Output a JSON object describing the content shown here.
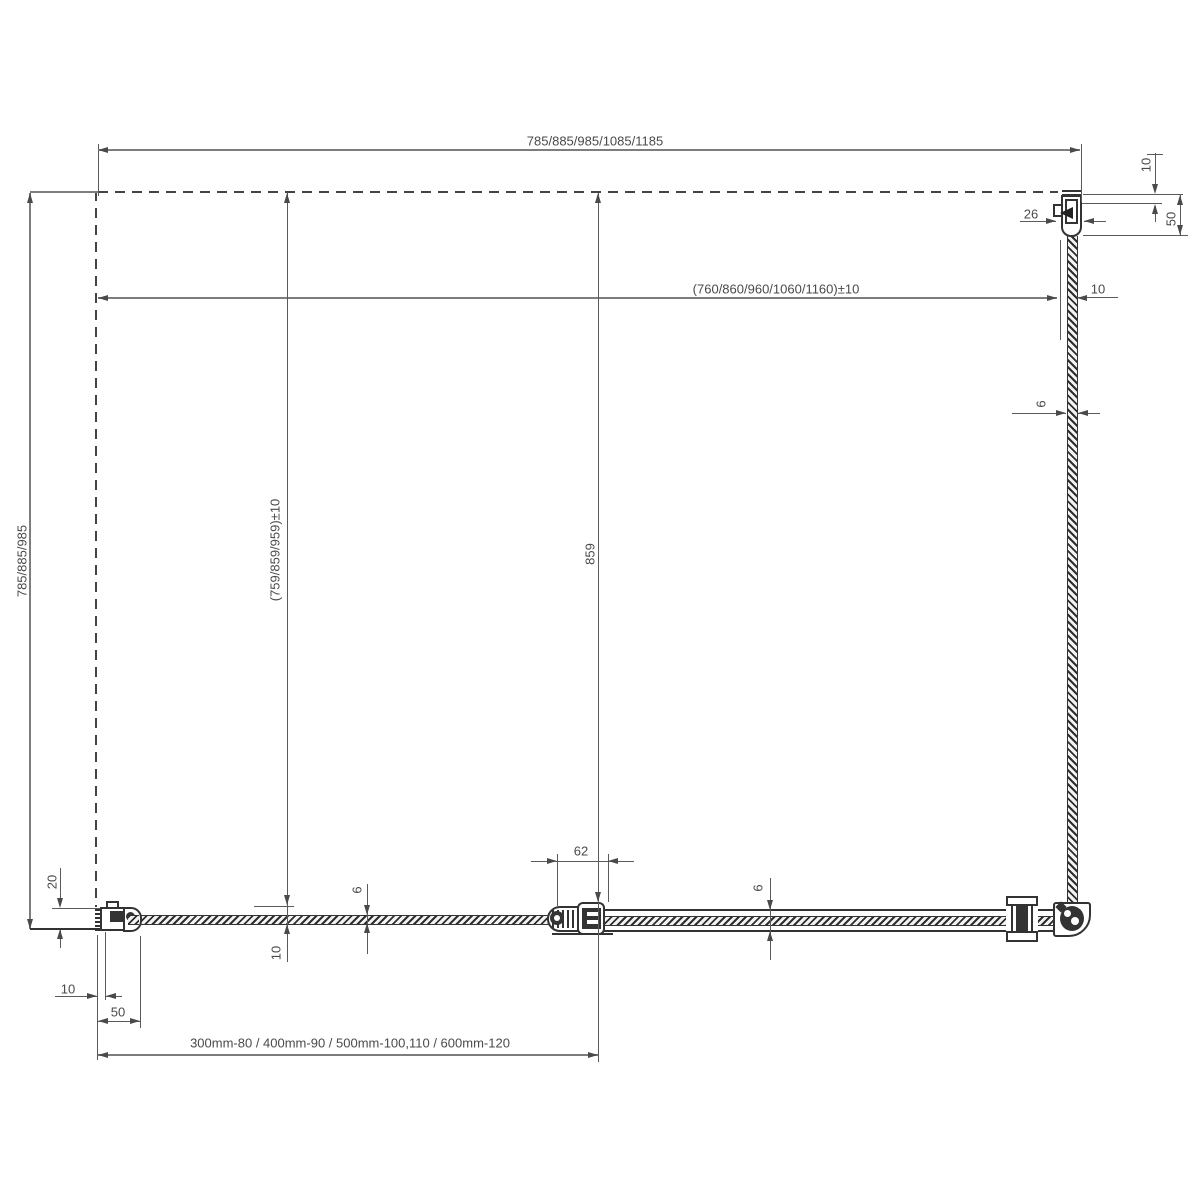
{
  "dims": {
    "top_width": "785/885/985/1085/1185",
    "glass_width": "(760/860/960/1060/1160)±10",
    "right_offset_10": "10",
    "right_profile_50": "50",
    "profile_26": "26",
    "right_gap_10": "10",
    "glass_6_side": "6",
    "depth_left": "785/885/985",
    "depth_inner": "(759/859/959)±10",
    "door_glass_859": "859",
    "wall_profile_20": "20",
    "hinge_62": "62",
    "glass_6_front_left": "6",
    "glass_6_front_right": "6",
    "front_offset_10": "10",
    "bottom_gap_10": "10",
    "bottom_profile_50": "50",
    "size_note": "300mm-80 / 400mm-90 / 500mm-100,110 / 600mm-120"
  }
}
